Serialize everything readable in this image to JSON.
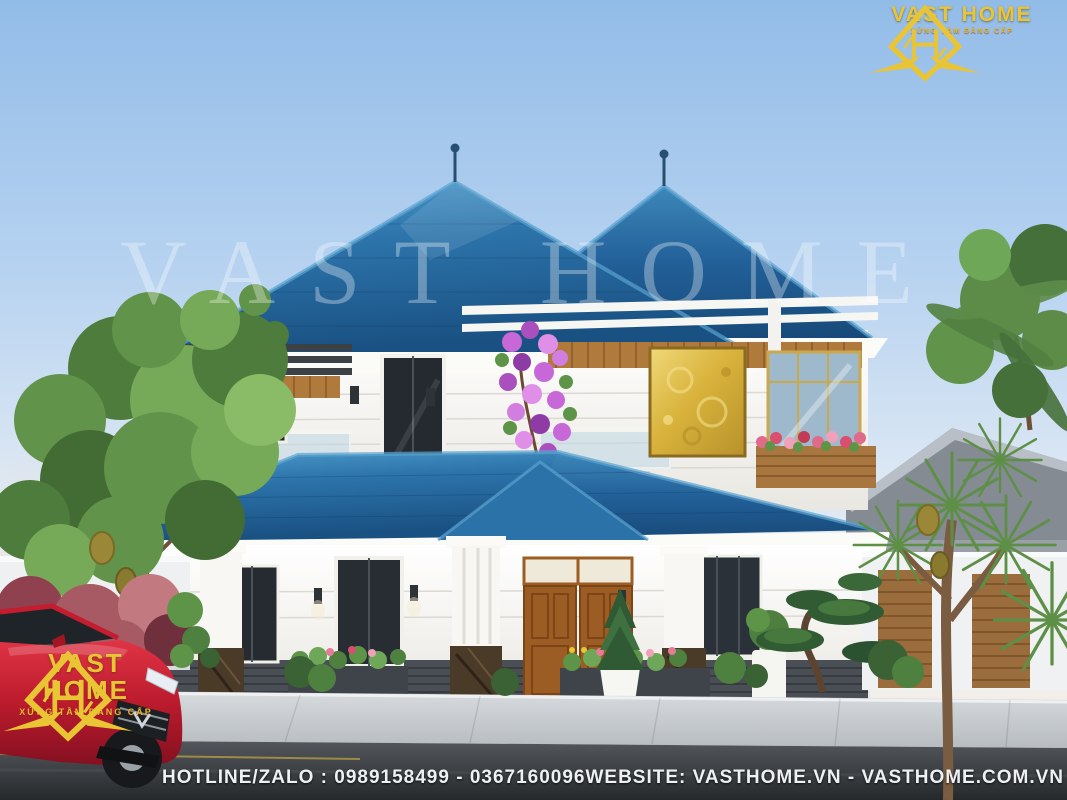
{
  "branding": {
    "name": "VAST HOME",
    "tagline": "XỨNG TẦM ĐẲNG CẤP",
    "watermark": "VAST HOME"
  },
  "footer": {
    "hotline_text": "HOTLINE/ZALO : 0989158499 - 0367160096",
    "website_text": "WEBSITE: VASTHOME.VN - VASTHOME.COM.VN"
  },
  "colors": {
    "brand_gold": "#e9c536",
    "roof_blue": "#2a6ea6",
    "sky_blue": "#98c1ea",
    "wall_white": "#f7f6f2",
    "wood_brown": "#b07a3c",
    "door_wood": "#9c5d24",
    "car_red": "#c41d30",
    "road_dark": "#3a3e42",
    "foliage_green": "#5d8f46",
    "flower_purple": "#c867d8",
    "flower_pink": "#e06a8a"
  },
  "scene": {
    "elements": [
      "two-story-villa",
      "blue-hip-roof",
      "gold-art-panel",
      "wood-double-door",
      "white-columns",
      "pergola",
      "bougainvillea",
      "jackfruit-tree",
      "yucca-palm",
      "bonsai-pine",
      "white-fence",
      "neighbor-house",
      "red-sedan-car",
      "sidewalk",
      "asphalt-road"
    ]
  }
}
